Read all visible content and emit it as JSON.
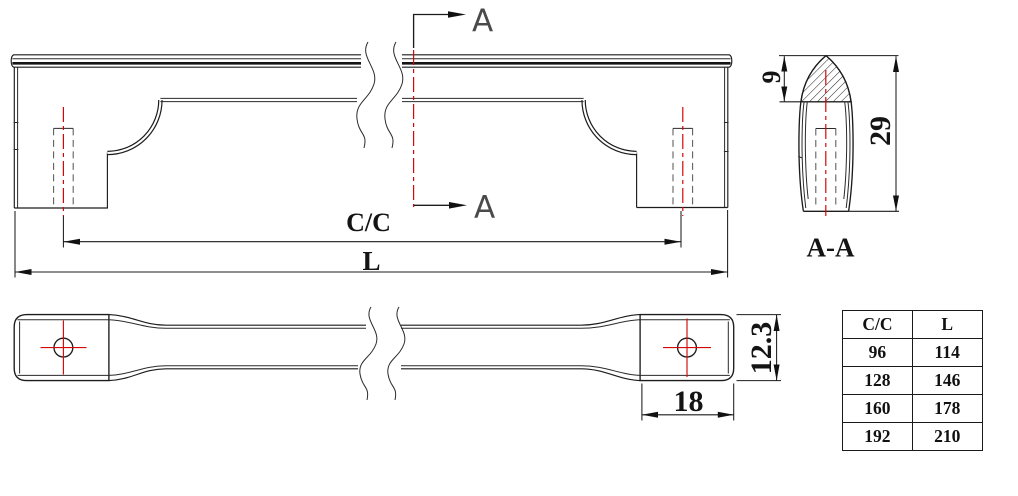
{
  "labels": {
    "section_arrow_top": "A",
    "section_arrow_bottom": "A",
    "section_view_title": "A-A",
    "dim_center_to_center": "C/C",
    "dim_overall_length": "L",
    "dim_cap_depth": "9",
    "dim_profile_height": "29",
    "dim_pad_width": "18",
    "dim_pad_height": "12.3"
  },
  "size_table": {
    "headers": [
      "C/C",
      "L"
    ],
    "rows": [
      [
        "96",
        "114"
      ],
      [
        "128",
        "146"
      ],
      [
        "160",
        "178"
      ],
      [
        "192",
        "210"
      ]
    ]
  },
  "colors": {
    "line": "#1c1c1c",
    "centerline_red": "#d40808",
    "hatch": "#2a2a2a",
    "background": "#ffffff"
  }
}
